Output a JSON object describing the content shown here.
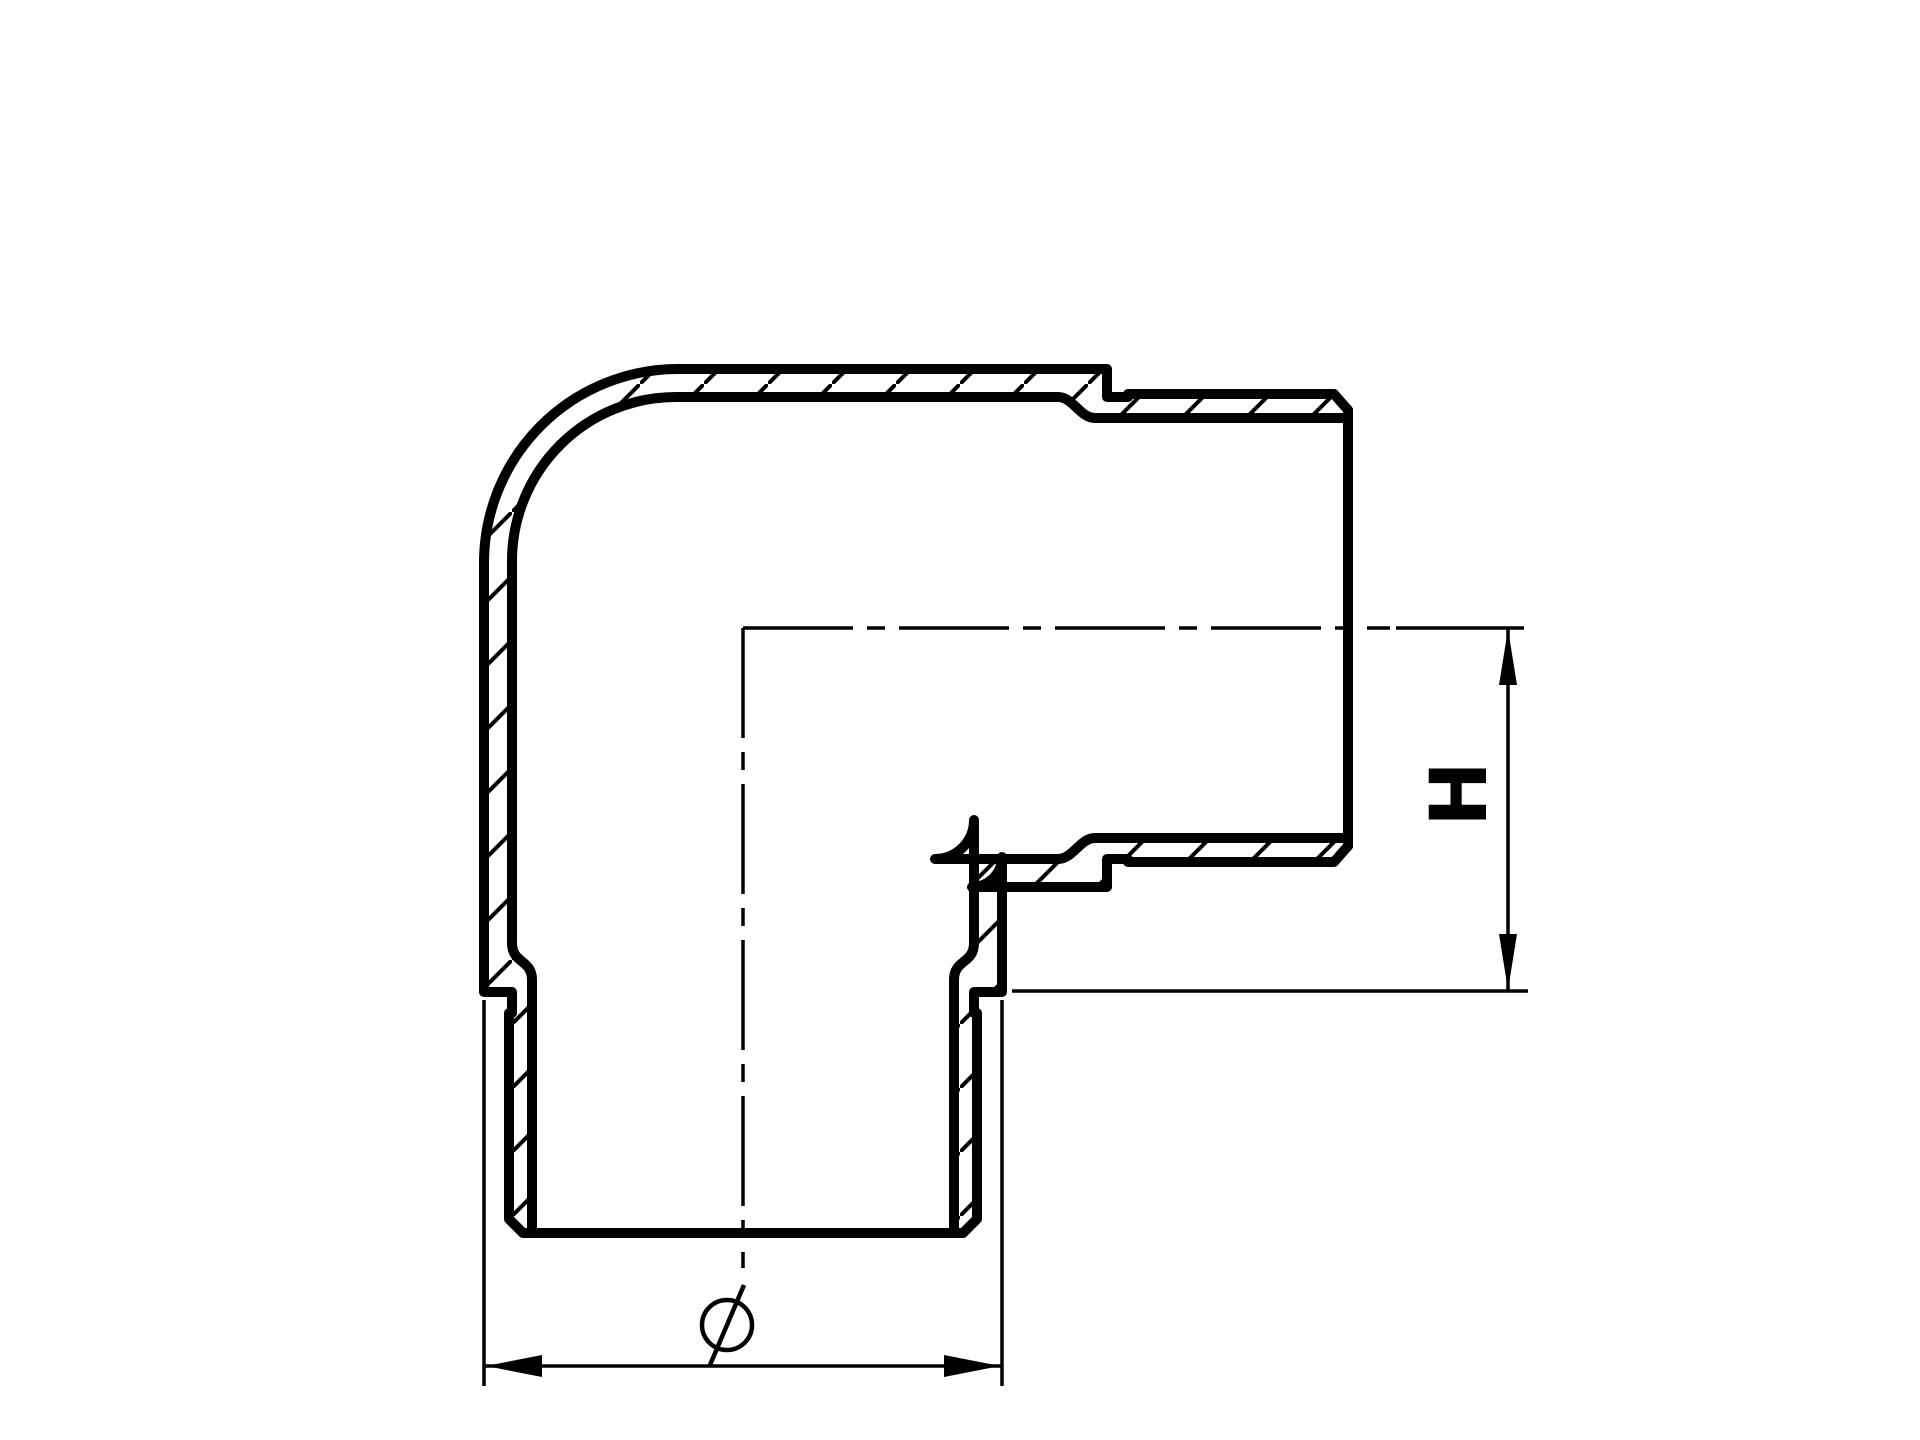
{
  "page": {
    "background_color": "#ffffff",
    "line_color": "#000000"
  },
  "drawing": {
    "title": "90-degree elbow fitting sectional view",
    "view": "cross-section with hatched walls",
    "labels": {
      "height_dimension": "H",
      "diameter_symbol": "Ø"
    }
  }
}
